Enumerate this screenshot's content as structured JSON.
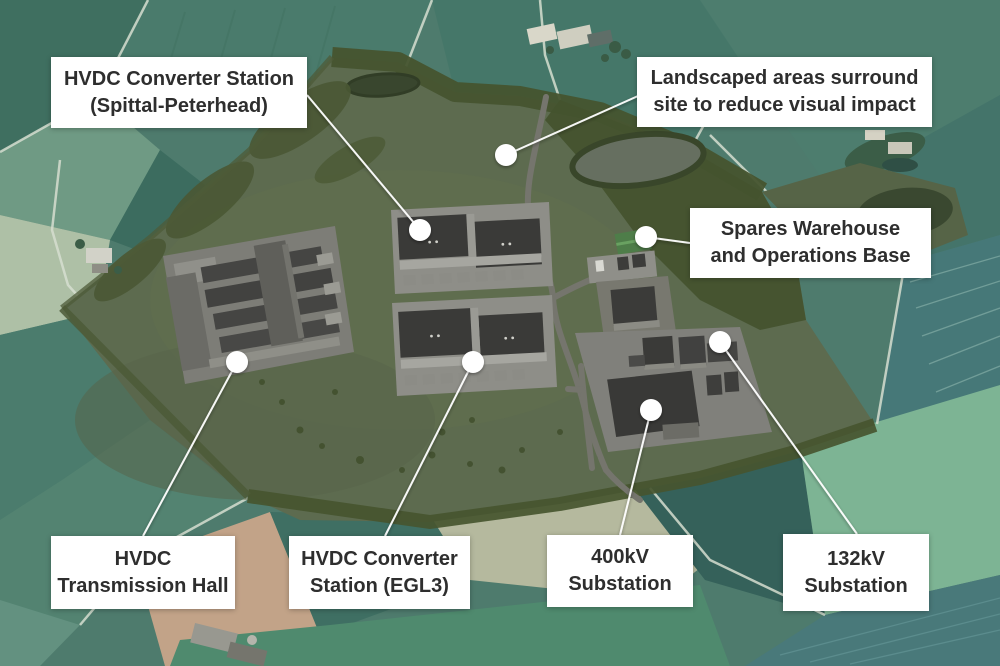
{
  "colors": {
    "label_background": "#ffffff",
    "label_text": "#2e2e2e",
    "marker_dot": "#ffffff",
    "leader_line": "#ffffff",
    "field_teal": "#4e7b6d",
    "site_olive": "#5d6b4f",
    "tree_dark_olive": "#45532e",
    "pad_gray": "#7d7d77",
    "building_dark": "#3a3a38",
    "warehouse_green": "#4e7d49",
    "plowed_tan": "#c2a388",
    "mint_field": "#7db494"
  },
  "callouts": [
    {
      "id": "spittal",
      "line1": "HVDC Converter Station",
      "line2": "(Spittal-Peterhead)"
    },
    {
      "id": "landscaped",
      "line1": "Landscaped areas surround",
      "line2": "site to reduce visual impact"
    },
    {
      "id": "spares",
      "line1": "Spares Warehouse",
      "line2": "and Operations Base"
    },
    {
      "id": "hall",
      "line1": "HVDC",
      "line2": "Transmission Hall"
    },
    {
      "id": "egl3",
      "line1": "HVDC Converter",
      "line2": "Station (EGL3)"
    },
    {
      "id": "kv400",
      "line1": "400kV",
      "line2": "Substation"
    },
    {
      "id": "kv132",
      "line1": "132kV",
      "line2": "Substation"
    }
  ]
}
